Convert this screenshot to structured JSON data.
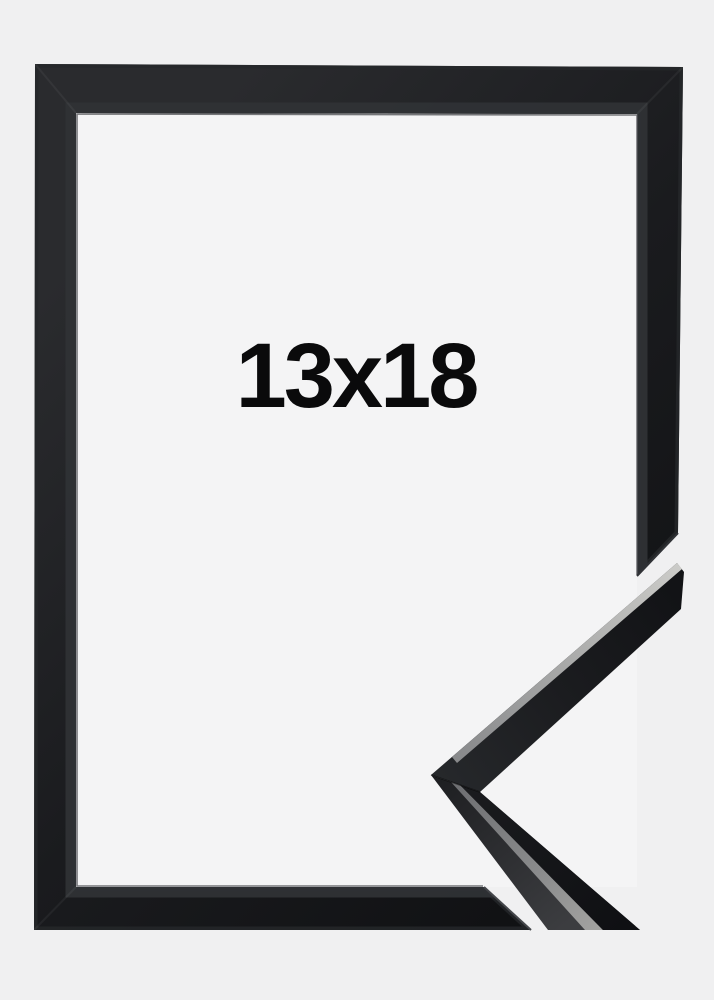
{
  "product": {
    "size_label": "13x18"
  },
  "colors": {
    "page_background": "#f0f0f1",
    "frame_interior": "#f4f4f5",
    "frame_black": "#17181a",
    "frame_bevel": "#2f3135",
    "lip_silver": "#b6b6b4",
    "label_text": "#0a0a0b"
  }
}
